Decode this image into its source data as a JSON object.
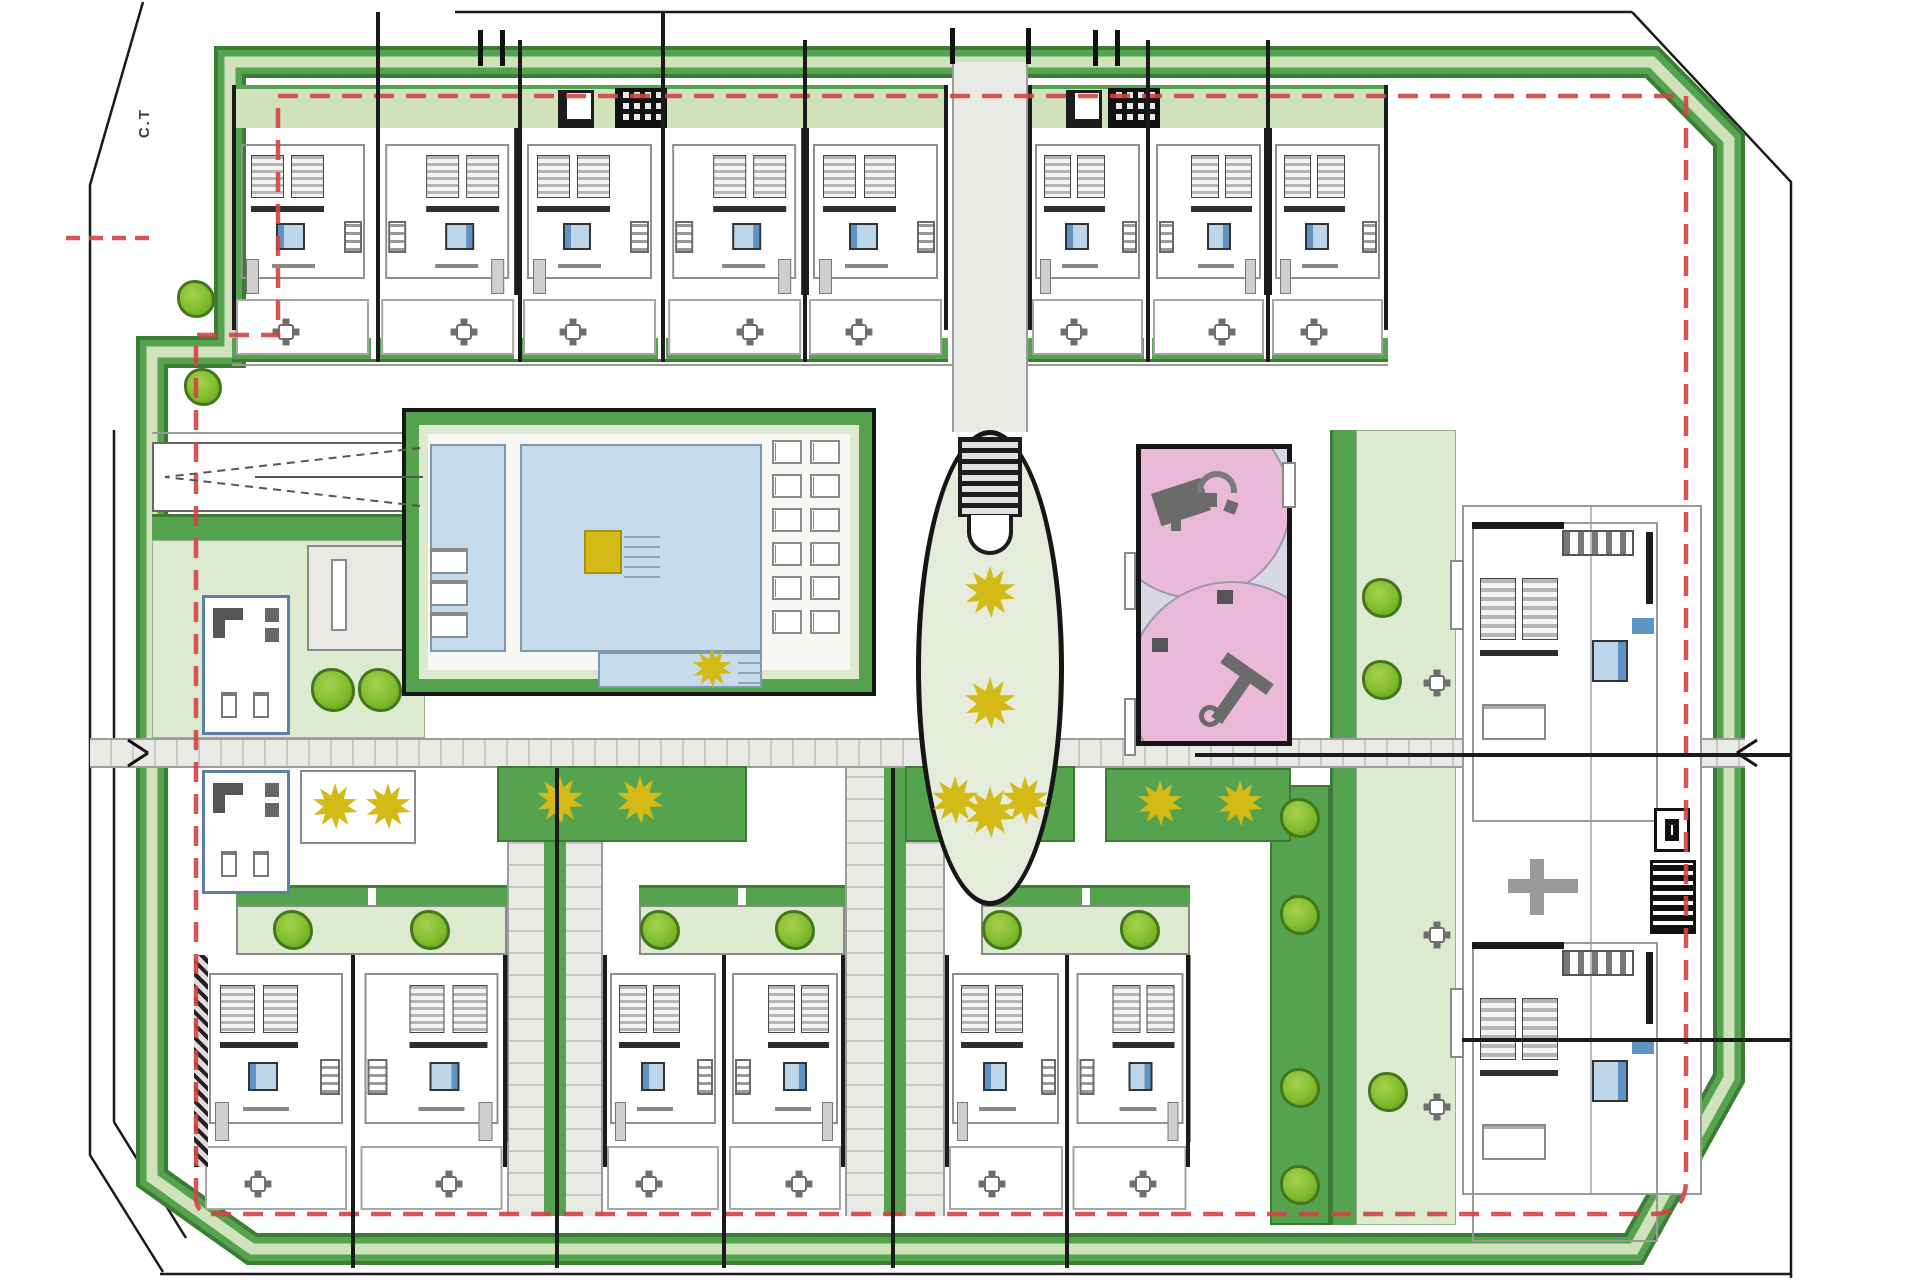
{
  "meta": {
    "plan_label": "C.T"
  },
  "colors": {
    "band_dark": "#3c7d36",
    "band": "#55a34e",
    "band_light": "#cfe2bc",
    "garden": "#dcead0",
    "garden_edge": "#9ab08e",
    "tree": "#82bd2e",
    "tree_dark": "#44771b",
    "gold": "#d3ba17",
    "pool_fill": "#c6dbeb",
    "pool_edge": "#7f98ab",
    "pink": "#e9b9d7",
    "lavender": "#d8d8e4",
    "red_dash": "#d24444",
    "walk": "#e9e9e5",
    "walk_edge": "#9c9c9c",
    "walk_line": "#c8c8c4",
    "wall": "#1b1b1b",
    "room": "#8f8f8f",
    "furn": "#cfcfcf",
    "furn_dark": "#6e6e6e",
    "bath": "#5e93c4",
    "bath_light": "#bdd5e9",
    "street": "#1a1a1a",
    "gray_bldg": "#e8e8e4"
  },
  "site": {
    "outline_band_path": "M 230,62 L 230,352 L 152,352 L 152,1178 L 252,1249 L 1634,1249 L 1729,1078 L 1729,140 L 1652,62 Z",
    "red_boundary_path": "M 196,1198 L 196,335 L 278,335 L 278,96 L 1686,96 L 1686,1180 Q 1686,1214 1652,1214 L 214,1214 Q 196,1214 196,1198 Z",
    "red_spur": [
      66,
      238,
      152,
      238
    ],
    "street_polylines": [
      "143,2 90,185 90,1155 163,1272",
      "1632,12 1791,182 1791,1278"
    ],
    "street_lines": [
      [
        455,
        12,
        1632,
        12
      ],
      [
        160,
        1274,
        1791,
        1274
      ],
      [
        114,
        430,
        114,
        1122
      ],
      [
        114,
        1122,
        186,
        1238
      ]
    ],
    "guide_lines": [
      [
        152,
        433,
        425,
        433
      ],
      [
        1452,
        430,
        1452,
        1225
      ],
      [
        232,
        365,
        1388,
        365
      ]
    ],
    "tall_walls_v": [
      [
        378,
        12,
        362
      ],
      [
        663,
        12,
        362
      ],
      [
        520,
        40,
        362
      ],
      [
        805,
        40,
        362
      ],
      [
        1148,
        40,
        362
      ],
      [
        1268,
        40,
        362
      ],
      [
        353,
        955,
        1268
      ],
      [
        724,
        955,
        1268
      ],
      [
        1067,
        955,
        1268
      ],
      [
        557,
        768,
        1268
      ],
      [
        893,
        768,
        1268
      ]
    ],
    "tall_walls_h": [
      [
        1195,
        755,
        1791
      ],
      [
        1462,
        1040,
        1791
      ]
    ],
    "band_ticks": [
      [
        478,
        30
      ],
      [
        500,
        30
      ],
      [
        1093,
        30
      ],
      [
        1115,
        30
      ],
      [
        950,
        28
      ],
      [
        1026,
        28
      ]
    ],
    "exit_chevrons": [
      [
        128,
        740,
        148,
        753
      ],
      [
        128,
        766,
        148,
        753
      ],
      [
        1757,
        740,
        1737,
        753
      ],
      [
        1757,
        766,
        1737,
        753
      ]
    ],
    "ramp": {
      "box": [
        152,
        442,
        271,
        70
      ],
      "chevron": [
        [
          420,
          448,
          165,
          477
        ],
        [
          420,
          506,
          165,
          477
        ]
      ],
      "center_line": [
        255,
        477,
        423,
        477
      ]
    },
    "walkways": {
      "main": [
        90,
        738,
        1655,
        30
      ],
      "top_center": [
        952,
        62,
        76,
        370
      ],
      "verticals": [
        [
          507,
          768,
          96,
          448
        ],
        [
          845,
          768,
          100,
          448
        ]
      ]
    },
    "top_blocks": [
      {
        "x": 232,
        "y": 85,
        "w": 716,
        "units": 5
      },
      {
        "x": 1028,
        "y": 85,
        "w": 360,
        "units": 3
      }
    ],
    "bottom_blocks": [
      {
        "x": 200,
        "y": 885,
        "w": 307,
        "units": 2,
        "hatch_left": true
      },
      {
        "x": 603,
        "y": 885,
        "w": 242,
        "units": 2
      },
      {
        "x": 945,
        "y": 885,
        "w": 245,
        "units": 2
      }
    ],
    "utility_boxes": [
      {
        "x": 558,
        "y": 90,
        "grid": false
      },
      {
        "x": 615,
        "y": 88,
        "grid": true
      },
      {
        "x": 1066,
        "y": 90,
        "grid": false
      },
      {
        "x": 1108,
        "y": 88,
        "grid": true
      }
    ],
    "amenity": {
      "bar": [
        152,
        514,
        271,
        26
      ],
      "terrace": [
        152,
        540,
        273,
        198
      ],
      "gray_building": [
        307,
        545,
        118,
        106
      ],
      "office_rooms": [
        [
          202,
          595,
          88,
          140
        ],
        [
          202,
          770,
          88,
          124
        ]
      ]
    },
    "planters": [
      {
        "x": 300,
        "y": 770,
        "w": 116,
        "h": 74,
        "green": false
      },
      {
        "x": 497,
        "y": 766,
        "w": 250,
        "h": 76,
        "green": true
      },
      {
        "x": 905,
        "y": 766,
        "w": 170,
        "h": 76,
        "green": true
      },
      {
        "x": 1105,
        "y": 768,
        "w": 186,
        "h": 74,
        "green": true
      }
    ],
    "pool": {
      "enclosure": [
        402,
        408,
        474,
        288
      ],
      "main": [
        520,
        444,
        242,
        208
      ],
      "lower_ext": [
        598,
        652,
        164,
        36
      ],
      "lap": [
        430,
        444,
        76,
        208
      ],
      "spa": [
        584,
        530,
        38,
        44
      ],
      "steps_a": [
        624,
        534,
        36,
        44
      ],
      "steps_b": [
        738,
        656,
        24,
        28
      ],
      "loungers_right": {
        "x": 772,
        "y": 440,
        "cols": 2,
        "rows": 6,
        "dx": 38,
        "dy": 34
      },
      "loungers_left": {
        "x": 430,
        "y": 548,
        "n": 3,
        "dy": 32
      }
    },
    "oval": {
      "cx": 990,
      "cy": 668,
      "rx": 74,
      "ry": 238
    },
    "playground": {
      "rect": [
        1136,
        444,
        156,
        302
      ],
      "benches_dark": [
        [
          1217,
          590
        ],
        [
          1152,
          638
        ]
      ],
      "benches_white": [
        [
          1124,
          552,
          12,
          58
        ],
        [
          1124,
          698,
          12,
          58
        ],
        [
          1282,
          462,
          14,
          46
        ]
      ]
    },
    "right_zone": {
      "edge_strip": [
        1330,
        430,
        26,
        795
      ],
      "garden": [
        1356,
        430,
        100,
        795
      ],
      "lower_strip": [
        1270,
        785,
        60,
        440
      ],
      "building": [
        1462,
        505,
        240,
        690
      ],
      "apartment_y": [
        520,
        940
      ],
      "stair": [
        1648,
        858,
        46,
        74
      ],
      "tables": [
        [
          1437,
          683
        ],
        [
          1437,
          935
        ],
        [
          1437,
          1107
        ]
      ],
      "benches": [
        [
          1450,
          560,
          14,
          70
        ],
        [
          1450,
          988,
          14,
          70
        ]
      ]
    },
    "trees": [
      [
        196,
        299,
        38
      ],
      [
        203,
        387,
        38
      ],
      [
        333,
        690,
        44
      ],
      [
        380,
        690,
        44
      ],
      [
        293,
        930,
        40
      ],
      [
        430,
        930,
        40
      ],
      [
        660,
        930,
        40
      ],
      [
        795,
        930,
        40
      ],
      [
        1002,
        930,
        40
      ],
      [
        1140,
        930,
        40
      ],
      [
        1382,
        598,
        40
      ],
      [
        1382,
        680,
        40
      ],
      [
        1300,
        818,
        40
      ],
      [
        1300,
        915,
        40
      ],
      [
        1300,
        1088,
        40
      ],
      [
        1300,
        1185,
        40
      ],
      [
        1388,
        1092,
        40
      ]
    ],
    "gold_plants": [
      [
        335,
        806,
        46
      ],
      [
        388,
        806,
        46
      ],
      [
        560,
        800,
        48
      ],
      [
        640,
        800,
        48
      ],
      [
        712,
        668,
        40
      ],
      [
        603,
        551,
        38
      ],
      [
        955,
        800,
        48
      ],
      [
        1025,
        800,
        48
      ],
      [
        990,
        592,
        52
      ],
      [
        990,
        703,
        52
      ],
      [
        990,
        812,
        52
      ],
      [
        1160,
        803,
        46
      ],
      [
        1240,
        803,
        46
      ]
    ]
  }
}
